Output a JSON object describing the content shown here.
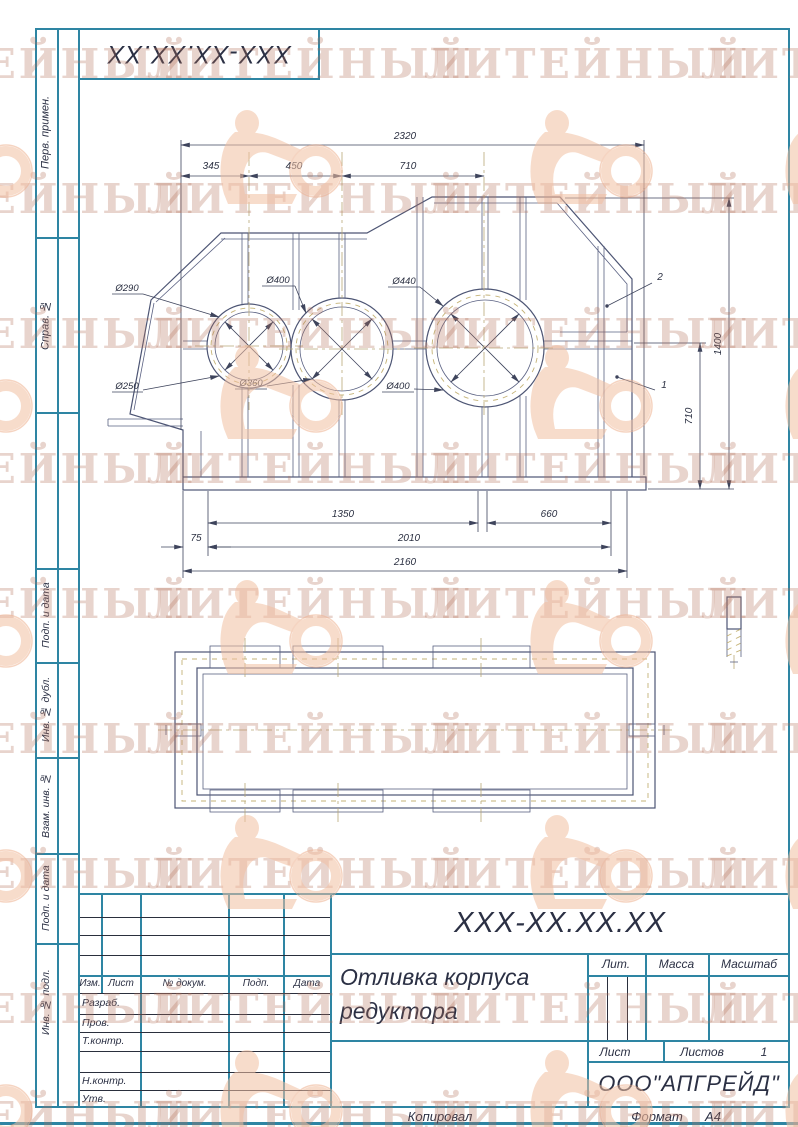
{
  "watermark": {
    "text": "ЛИТЕЙНЫЙ"
  },
  "corner_stamp": {
    "designation": "XXX-XX.XX.XX"
  },
  "margin_labels": {
    "perv_primen": "Перв. примен.",
    "sprav_no": "Справ. №",
    "podp_data_1": "Подп. и дата",
    "inv_dubl": "Инв. № дубл.",
    "vzam_inv": "Взам. инв. №",
    "podp_data_2": "Подп. и дата",
    "inv_podl": "Инв. № подл."
  },
  "title_block": {
    "designation": "XXX-XX.XX.XX",
    "name_line1": "Отливка корпуса",
    "name_line2": "редуктора",
    "company": "ООО\"АПГРЕЙД\"",
    "lit_label": "Лит.",
    "mass_label": "Масса",
    "scale_label": "Масштаб",
    "sheet_label": "Лист",
    "sheets_label": "Листов",
    "sheets_value": "1",
    "col_izm": "Изм.",
    "col_list": "Лист",
    "col_doc": "№ докум.",
    "col_podp": "Подп.",
    "col_data": "Дата",
    "row_razrab": "Разраб.",
    "row_prov": "Пров.",
    "row_tkontr": "Т.контр.",
    "row_nkontr": "Н.контр.",
    "row_utv": "Утв."
  },
  "footer": {
    "copied": "Копировал",
    "format_label": "Формат",
    "format_value": "А4"
  },
  "drawing": {
    "dims": {
      "top_total": "2320",
      "top_1": "345",
      "top_2": "450",
      "top_3": "710",
      "bot_1": "1350",
      "bot_2": "660",
      "bot_3": "75",
      "bot_4": "2010",
      "bot_5": "2160",
      "right_outer": "1400",
      "right_inner": "710"
    },
    "diameters": {
      "c1_top": "Ø290",
      "c2_top": "Ø400",
      "c3_top": "Ø440",
      "c1_bot": "Ø250",
      "c2_bot": "Ø360",
      "c3_bot": "Ø400"
    },
    "callouts": {
      "pos1": "1",
      "pos2": "2"
    }
  }
}
